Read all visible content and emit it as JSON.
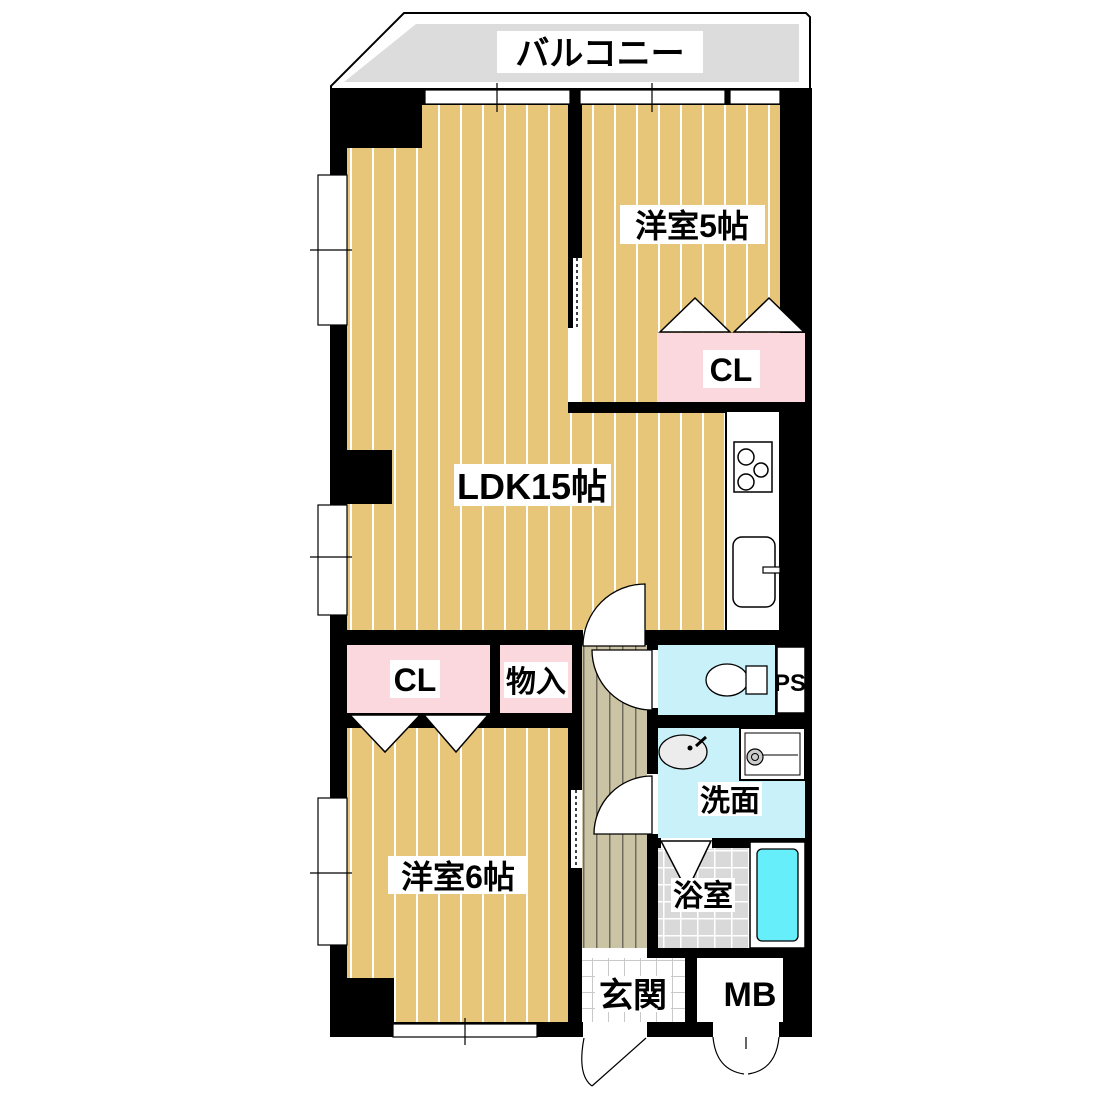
{
  "plan": {
    "type": "apartment-floor-plan",
    "labels": {
      "balcony": "バルコニー",
      "western_room_5": "洋室5帖",
      "ldk": "LDK15帖",
      "closet_upper": "CL",
      "closet_lower": "CL",
      "storage": "物入",
      "pipe_space": "PS",
      "washroom": "洗面",
      "bathroom": "浴室",
      "western_room_6": "洋室6帖",
      "entrance": "玄関",
      "meter_box": "MB"
    },
    "colors": {
      "wall": "#000000",
      "floor_tan": "#e7c679",
      "stripe_white": "#ffffff",
      "closet_pink": "#fbd8dd",
      "wet_cyan": "#c9f1fa",
      "tub_cyan": "#66eefa",
      "balcony_gray": "#dcdcdc",
      "bath_tile_gray": "#d9d9d9",
      "hallway_beige": "#cbc4a4",
      "hallway_line": "#6f6b5e",
      "entrance_tile_line": "#c9c9c9"
    }
  }
}
